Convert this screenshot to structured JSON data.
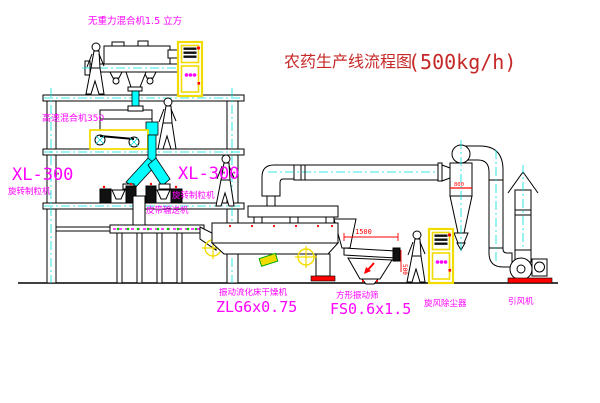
{
  "title": {
    "cn": "农药生产线流程图",
    "capacity": "(500kg/h)"
  },
  "labels": {
    "top_mixer": "无重力混合机1.5 立方",
    "high_speed_mixer": "高速混合机350",
    "xl300_left": "XL-300",
    "granulator_left": "旋转制粒机",
    "xl300_right": "XL-300",
    "granulator_right": "旋转制粒机",
    "belt_conveyor": "皮带输送机",
    "dryer_name": "振动流化床干燥机",
    "dryer_model": "ZLG6x0.75",
    "screen_name": "方形振动筛",
    "screen_model": "FS0.6x1.5",
    "cyclone_name": "旋风除尘器",
    "fan_name": "引风机"
  },
  "dimensions": {
    "screen_length": "1500",
    "screen_side": "500",
    "cyclone_dia": "800"
  },
  "colors": {
    "label_magenta": "#ff00ff",
    "title_red": "#c62828",
    "dim_red": "#ff0000",
    "pipe_cyan": "#00ffff",
    "cabinet_yellow": "#f2dc00",
    "conveyor_green": "#00cc00"
  }
}
